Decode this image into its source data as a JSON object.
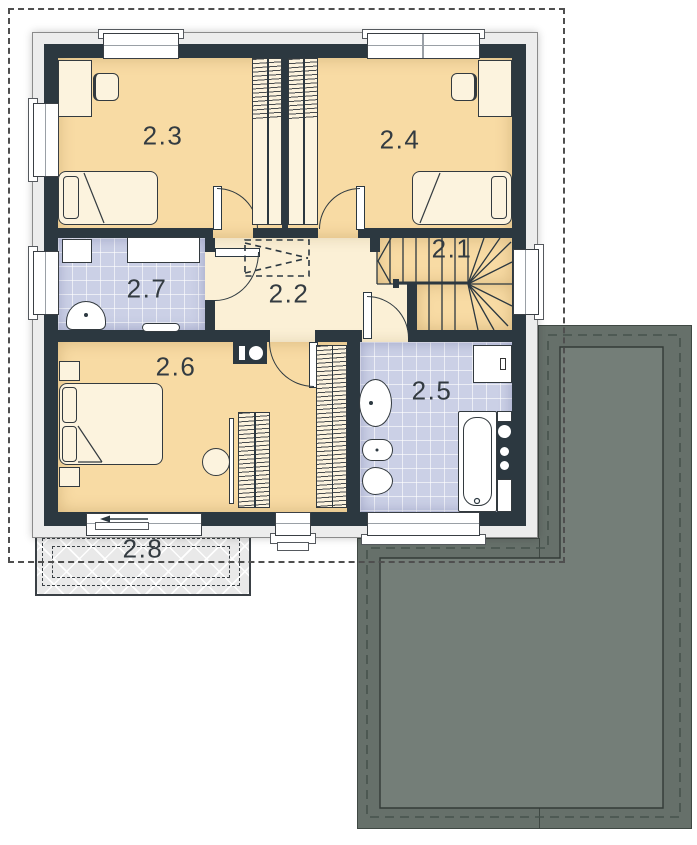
{
  "plan": {
    "rooms": [
      {
        "label": "2.1"
      },
      {
        "label": "2.2"
      },
      {
        "label": "2.3"
      },
      {
        "label": "2.4"
      },
      {
        "label": "2.5"
      },
      {
        "label": "2.6"
      },
      {
        "label": "2.7"
      },
      {
        "label": "2.8"
      }
    ]
  },
  "colors": {
    "wall": "#2C3840",
    "bedroom_floor": "#F8DBA4",
    "hallway_floor": "#FBF0D6",
    "bathroom_floor": "#CBD0E6",
    "furniture": "#FCF3DE",
    "roof": "#66706A",
    "roof_inner": "#747E78",
    "balcony": "#E9E9E9"
  }
}
